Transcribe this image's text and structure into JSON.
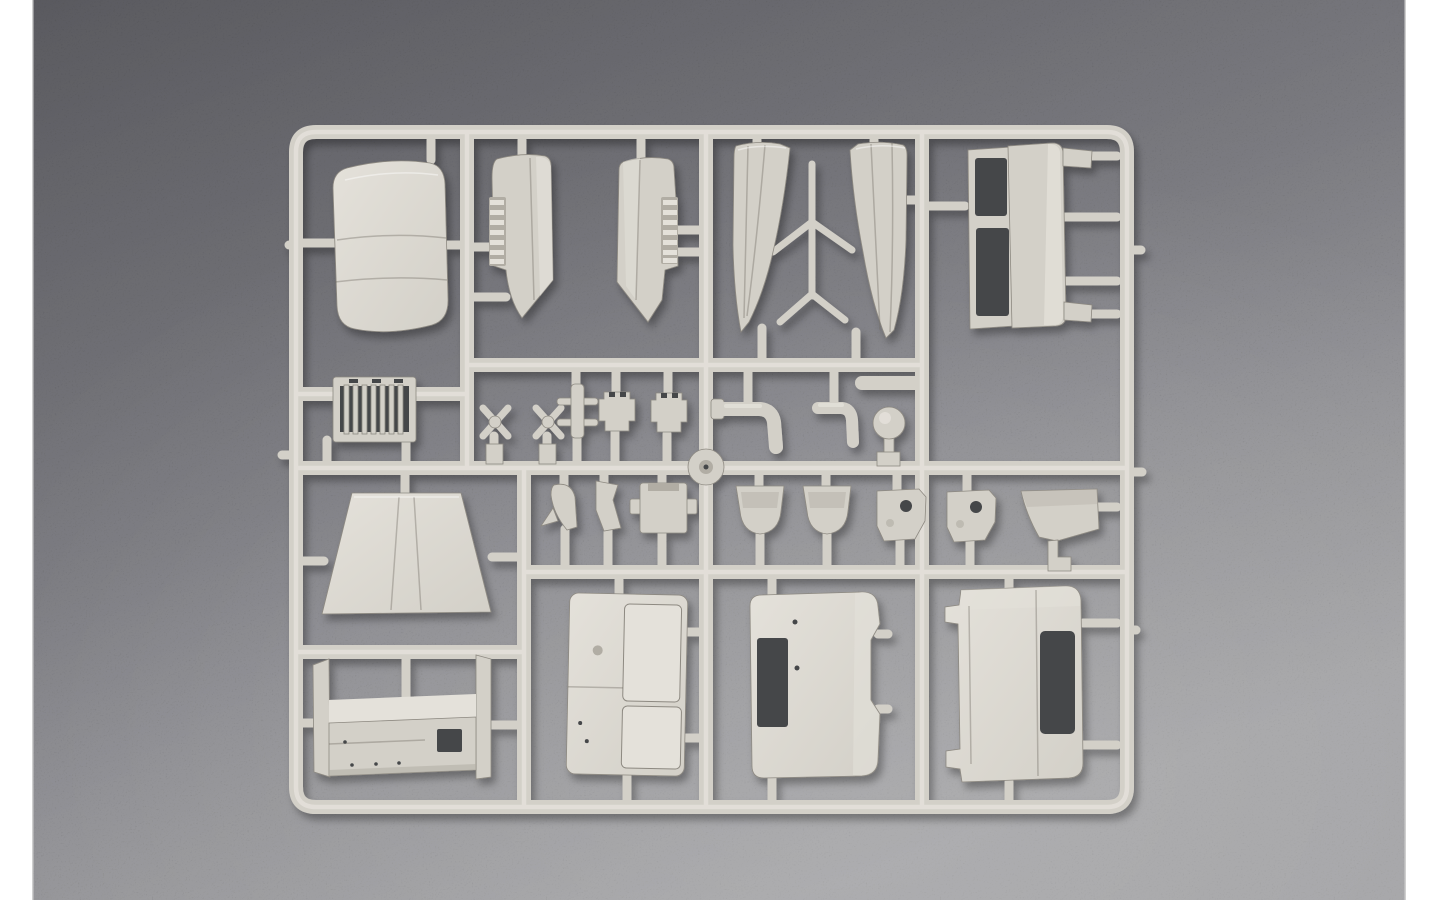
{
  "scene": {
    "type": "photograph",
    "subject": "plastic model kit sprue with unassembled truck-cab parts",
    "surface": "dark gray speckled background",
    "framing": "white vertical bars on left and right edges"
  },
  "colors": {
    "backdrop": "#ffffff",
    "bg_top": "#4c4c50",
    "bg_mid": "#67676b",
    "bg_bottom": "#909092",
    "plastic_base": "#d3d0c8",
    "plastic_light": "#e4e1da",
    "plastic_dark": "#b1ada4",
    "plastic_edge": "#8d8981",
    "opening_dark": "#45464a"
  },
  "parts": [
    {
      "id": "sprue-frame",
      "label": "injection-molded sprue runner frame"
    },
    {
      "id": "roof-panel",
      "label": "curved cab roof panel"
    },
    {
      "id": "louver-blade-left",
      "label": "louvered blade part, left-hand"
    },
    {
      "id": "louver-blade-right",
      "label": "louvered blade part, right-hand"
    },
    {
      "id": "pillar-panel-pair",
      "label": "pair of curved pillar panels with cross braces"
    },
    {
      "id": "door-frame",
      "label": "door frame with two window openings"
    },
    {
      "id": "radiator-grille",
      "label": "radiator grille with vertical slats"
    },
    {
      "id": "x-linkage-1",
      "label": "X-shaped linkage part"
    },
    {
      "id": "x-linkage-2",
      "label": "X-shaped linkage part"
    },
    {
      "id": "pinned-shaft",
      "label": "shaft with cross pins"
    },
    {
      "id": "notched-block-1",
      "label": "notched block part"
    },
    {
      "id": "notched-block-2",
      "label": "notched block part"
    },
    {
      "id": "elbow-pipe-large",
      "label": "large elbow pipe"
    },
    {
      "id": "elbow-pipe-small",
      "label": "small elbow pipe"
    },
    {
      "id": "ball-knob",
      "label": "ball knob with stem"
    },
    {
      "id": "hub-disc",
      "label": "round hub disc"
    },
    {
      "id": "fin-bracket-1",
      "label": "curved fin bracket"
    },
    {
      "id": "fin-bracket-2",
      "label": "angular fin bracket"
    },
    {
      "id": "tabbed-block",
      "label": "block with side tabs"
    },
    {
      "id": "seat-bucket-1",
      "label": "bucket-shaped part"
    },
    {
      "id": "seat-bucket-2",
      "label": "bucket-shaped part"
    },
    {
      "id": "holed-bracket-1",
      "label": "bracket with round hole"
    },
    {
      "id": "holed-bracket-2",
      "label": "bracket with round hole"
    },
    {
      "id": "mudflap-wedge",
      "label": "wedge-shaped mud flap part"
    },
    {
      "id": "hood-panel",
      "label": "trapezoidal hood panel"
    },
    {
      "id": "cargo-floor-channel",
      "label": "open channel floor part with end plates"
    },
    {
      "id": "door-panel",
      "label": "cab door panel with recessed window"
    },
    {
      "id": "cab-back-panel",
      "label": "cab back panel with window cutout"
    },
    {
      "id": "cab-side-panel",
      "label": "cab side panel with door window opening"
    }
  ]
}
